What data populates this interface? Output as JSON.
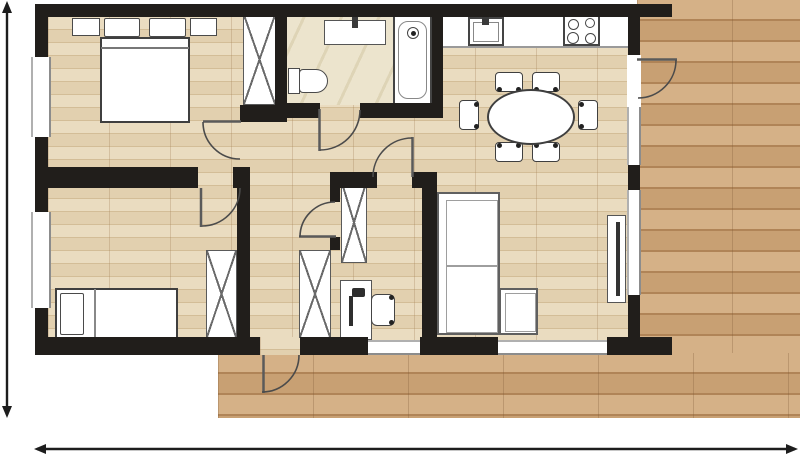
{
  "canvas": {
    "width": 800,
    "height": 456
  },
  "colors": {
    "wall": "#211e1b",
    "interior_floor": "#e8d8b9",
    "deck_floor": "#d1a97b",
    "tile_floor": "#ece4cd",
    "furniture_outline": "#4a4a4a",
    "door_arc": "#4b4b4b",
    "dimension": "#1d1d1d",
    "background": "#ffffff"
  },
  "plan": {
    "elements": [
      {
        "n": "deck-right",
        "c": "f-deck",
        "x": 637,
        "y": 0,
        "w": 163,
        "h": 418
      },
      {
        "n": "deck-balcony",
        "c": "f-deck",
        "x": 218,
        "y": 353,
        "w": 582,
        "h": 65
      },
      {
        "n": "interior-floor",
        "c": "f-wood",
        "x": 48,
        "y": 17,
        "w": 580,
        "h": 323
      },
      {
        "n": "balcony-doorway-floor",
        "c": "f-wood",
        "x": 260,
        "y": 337,
        "w": 40,
        "h": 18
      },
      {
        "n": "bathroom-floor",
        "c": "f-tile",
        "x": 287,
        "y": 17,
        "w": 145,
        "h": 88
      },
      {
        "n": "nightstand-left",
        "c": "box",
        "x": 72,
        "y": 18,
        "w": 28,
        "h": 18
      },
      {
        "n": "nightstand-right",
        "c": "box",
        "x": 190,
        "y": 18,
        "w": 27,
        "h": 18
      },
      {
        "n": "pillow-left",
        "c": "box",
        "x": 104,
        "y": 18,
        "w": 36,
        "h": 19,
        "r": "2px"
      },
      {
        "n": "pillow-right",
        "c": "box",
        "x": 149,
        "y": 18,
        "w": 37,
        "h": 19,
        "r": "2px"
      },
      {
        "n": "double-bed",
        "c": "box",
        "x": 100,
        "y": 37,
        "w": 90,
        "h": 86,
        "bw": 2,
        "bc": "#3f3f3f"
      },
      {
        "n": "double-bed-blanket-line",
        "c": "dark",
        "x": 101,
        "y": 47,
        "w": 88,
        "h": 2,
        "bg": "#777"
      },
      {
        "n": "wardrobe-bedroom1",
        "c": "xbox",
        "x": 243,
        "y": 14,
        "w": 33,
        "h": 91
      },
      {
        "n": "vanity-counter",
        "c": "box",
        "x": 324,
        "y": 20,
        "w": 62,
        "h": 25,
        "bc": "#555"
      },
      {
        "n": "vanity-faucet",
        "c": "dark",
        "x": 352,
        "y": 15,
        "w": 6,
        "h": 13
      },
      {
        "n": "toilet-tank",
        "c": "box",
        "x": 288,
        "y": 68,
        "w": 12,
        "h": 26
      },
      {
        "n": "toilet-bowl",
        "c": "box",
        "x": 299,
        "y": 69,
        "w": 29,
        "h": 24,
        "r": "4px 12px 12px 4px"
      },
      {
        "n": "bathtub",
        "c": "box",
        "x": 393,
        "y": 15,
        "w": 39,
        "h": 90,
        "bw": 2,
        "bc": "#444"
      },
      {
        "n": "bathtub-inner",
        "c": "box",
        "x": 398,
        "y": 21,
        "w": 29,
        "h": 78,
        "bw": 1.2,
        "bc": "#888",
        "r": "10px"
      },
      {
        "n": "shower-head",
        "c": "box",
        "x": 407,
        "y": 27,
        "w": 12,
        "h": 12,
        "bc": "#444",
        "r": "50%",
        "dots": [
          [
            413,
            33
          ]
        ]
      },
      {
        "n": "kitchen-counter",
        "c": "white",
        "x": 443,
        "y": 17,
        "w": 185,
        "h": 31,
        "bb": "2px solid #9a9a9a"
      },
      {
        "n": "kitchen-sink",
        "c": "box",
        "x": 468,
        "y": 17,
        "w": 36,
        "h": 29,
        "bw": 2,
        "bc": "#444"
      },
      {
        "n": "kitchen-sink-inner",
        "c": "box",
        "x": 473,
        "y": 22,
        "w": 26,
        "h": 20,
        "bw": 1.2,
        "bc": "#888"
      },
      {
        "n": "kitchen-faucet",
        "c": "dark",
        "x": 482,
        "y": 13,
        "w": 7,
        "h": 12
      },
      {
        "n": "stove",
        "c": "box",
        "x": 563,
        "y": 15,
        "w": 37,
        "h": 31,
        "bw": 2,
        "bc": "#444",
        "rings": [
          [
            572,
            23,
            9
          ],
          [
            589,
            22,
            8
          ],
          [
            572,
            37,
            10
          ],
          [
            589,
            37,
            9
          ]
        ]
      },
      {
        "n": "dining-chair-top-1",
        "c": "box",
        "x": 495,
        "y": 72,
        "w": 28,
        "h": 20,
        "bc": "#3f3f3f",
        "r": "4px",
        "dots": [
          [
            499,
            89
          ],
          [
            518,
            89
          ]
        ]
      },
      {
        "n": "dining-chair-top-2",
        "c": "box",
        "x": 532,
        "y": 72,
        "w": 28,
        "h": 20,
        "bc": "#3f3f3f",
        "r": "4px",
        "dots": [
          [
            536,
            89
          ],
          [
            555,
            89
          ]
        ]
      },
      {
        "n": "dining-chair-bottom-1",
        "c": "box",
        "x": 495,
        "y": 142,
        "w": 28,
        "h": 20,
        "bc": "#3f3f3f",
        "r": "4px",
        "dots": [
          [
            499,
            145
          ],
          [
            518,
            145
          ]
        ]
      },
      {
        "n": "dining-chair-bottom-2",
        "c": "box",
        "x": 532,
        "y": 142,
        "w": 28,
        "h": 20,
        "bc": "#3f3f3f",
        "r": "4px",
        "dots": [
          [
            536,
            145
          ],
          [
            555,
            145
          ]
        ]
      },
      {
        "n": "dining-chair-left",
        "c": "box",
        "x": 459,
        "y": 100,
        "w": 20,
        "h": 30,
        "bc": "#3f3f3f",
        "r": "4px",
        "dots": [
          [
            476,
            104
          ],
          [
            476,
            126
          ]
        ]
      },
      {
        "n": "dining-chair-right",
        "c": "box",
        "x": 578,
        "y": 100,
        "w": 20,
        "h": 30,
        "bc": "#3f3f3f",
        "r": "4px",
        "dots": [
          [
            581,
            104
          ],
          [
            581,
            126
          ]
        ]
      },
      {
        "n": "dining-table",
        "c": "box",
        "x": 487,
        "y": 89,
        "w": 88,
        "h": 56,
        "bw": 2,
        "bc": "#3f3f3f",
        "r": "50%"
      },
      {
        "n": "sofa",
        "c": "box",
        "x": 437,
        "y": 192,
        "w": 63,
        "h": 143,
        "bw": 2,
        "bc": "#606060"
      },
      {
        "n": "sofa-cushions",
        "c": "box",
        "x": 446,
        "y": 200,
        "w": 52,
        "h": 133,
        "bw": 1.2,
        "bc": "#9e9e9e"
      },
      {
        "n": "sofa-cushion-divider",
        "c": "dark",
        "x": 447,
        "y": 265,
        "w": 50,
        "h": 2,
        "bg": "#9e9e9e"
      },
      {
        "n": "sofa-chaise",
        "c": "box",
        "x": 499,
        "y": 288,
        "w": 39,
        "h": 47,
        "bw": 2,
        "bc": "#606060"
      },
      {
        "n": "sofa-chaise-cushion",
        "c": "box",
        "x": 505,
        "y": 293,
        "w": 31,
        "h": 39,
        "bw": 1.2,
        "bc": "#9e9e9e"
      },
      {
        "n": "tv-stand",
        "c": "box",
        "x": 607,
        "y": 215,
        "w": 19,
        "h": 88,
        "bc": "#555"
      },
      {
        "n": "tv-panel",
        "c": "dark",
        "x": 616,
        "y": 222,
        "w": 4,
        "h": 74,
        "bg": "#333"
      },
      {
        "n": "wardrobe-office",
        "c": "xbox",
        "x": 341,
        "y": 182,
        "w": 26,
        "h": 81
      },
      {
        "n": "desk",
        "c": "box",
        "x": 340,
        "y": 280,
        "w": 32,
        "h": 60,
        "bc": "#555"
      },
      {
        "n": "desk-lamp-stem",
        "c": "dark",
        "x": 349,
        "y": 296,
        "w": 4,
        "h": 30,
        "bg": "#2e2e2e"
      },
      {
        "n": "desk-lamp-head",
        "c": "dark",
        "x": 352,
        "y": 288,
        "w": 13,
        "h": 9,
        "bg": "#2e2e2e",
        "r": "2px"
      },
      {
        "n": "office-chair",
        "c": "box",
        "x": 371,
        "y": 294,
        "w": 24,
        "h": 32,
        "bc": "#444",
        "r": "6px",
        "dots": [
          [
            391,
            297
          ],
          [
            391,
            322
          ]
        ]
      },
      {
        "n": "wardrobe-bedroom2",
        "c": "xbox",
        "x": 206,
        "y": 250,
        "w": 31,
        "h": 88
      },
      {
        "n": "closet-hall",
        "c": "xbox",
        "x": 299,
        "y": 250,
        "w": 32,
        "h": 88
      },
      {
        "n": "single-bed",
        "c": "box",
        "x": 55,
        "y": 288,
        "w": 123,
        "h": 52,
        "bw": 2,
        "bc": "#3f3f3f"
      },
      {
        "n": "single-bed-pillow",
        "c": "box",
        "x": 60,
        "y": 293,
        "w": 24,
        "h": 42,
        "r": "2px"
      },
      {
        "n": "single-bed-fold-line",
        "c": "dark",
        "x": 94,
        "y": 289,
        "w": 2,
        "h": 50,
        "bg": "#888"
      },
      {
        "n": "wall-top",
        "c": "wall",
        "x": 35,
        "y": 4,
        "w": 637,
        "h": 13
      },
      {
        "n": "wall-left",
        "c": "wall",
        "x": 35,
        "y": 4,
        "w": 13,
        "h": 351
      },
      {
        "n": "wall-bottom-1",
        "c": "wall",
        "x": 35,
        "y": 337,
        "w": 225,
        "h": 18
      },
      {
        "n": "wall-bottom-2",
        "c": "wall",
        "x": 300,
        "y": 337,
        "w": 68,
        "h": 18
      },
      {
        "n": "wall-bottom-3",
        "c": "wall",
        "x": 420,
        "y": 337,
        "w": 78,
        "h": 18
      },
      {
        "n": "wall-bottom-4",
        "c": "wall",
        "x": 607,
        "y": 337,
        "w": 65,
        "h": 18
      },
      {
        "n": "wall-right",
        "c": "wall",
        "x": 628,
        "y": 4,
        "w": 12,
        "h": 351
      },
      {
        "n": "wall-bathroom-left",
        "c": "wall",
        "x": 275,
        "y": 17,
        "w": 12,
        "h": 101
      },
      {
        "n": "wall-bathroom-kitchen",
        "c": "wall",
        "x": 432,
        "y": 17,
        "w": 11,
        "h": 101
      },
      {
        "n": "wall-bathroom-south-1",
        "c": "wall",
        "x": 287,
        "y": 103,
        "w": 33,
        "h": 15
      },
      {
        "n": "wall-bathroom-south-2",
        "c": "wall",
        "x": 360,
        "y": 103,
        "w": 72,
        "h": 15
      },
      {
        "n": "wall-bedroom1-nook",
        "c": "wall",
        "x": 240,
        "y": 105,
        "w": 47,
        "h": 17
      },
      {
        "n": "wall-bedroom-divider",
        "c": "wall",
        "x": 35,
        "y": 167,
        "w": 163,
        "h": 21
      },
      {
        "n": "wall-bedroom-divider-right",
        "c": "wall",
        "x": 233,
        "y": 167,
        "w": 17,
        "h": 21
      },
      {
        "n": "wall-corridor-left",
        "c": "wall",
        "x": 237,
        "y": 188,
        "w": 13,
        "h": 149
      },
      {
        "n": "wall-office-top-1",
        "c": "wall",
        "x": 330,
        "y": 172,
        "w": 47,
        "h": 16
      },
      {
        "n": "wall-office-top-2",
        "c": "wall",
        "x": 412,
        "y": 172,
        "w": 25,
        "h": 16
      },
      {
        "n": "wall-office-left-1",
        "c": "wall",
        "x": 330,
        "y": 188,
        "w": 10,
        "h": 14
      },
      {
        "n": "wall-office-left-2",
        "c": "wall",
        "x": 330,
        "y": 237,
        "w": 10,
        "h": 13
      },
      {
        "n": "wall-office-right",
        "c": "wall",
        "x": 422,
        "y": 188,
        "w": 15,
        "h": 149
      },
      {
        "n": "window-bedroom1",
        "c": "win-v",
        "x": 31,
        "y": 57,
        "w": 20,
        "h": 80
      },
      {
        "n": "window-bedroom2",
        "c": "win-v",
        "x": 31,
        "y": 212,
        "w": 20,
        "h": 96
      },
      {
        "n": "entry-opening",
        "c": "white",
        "x": 627,
        "y": 55,
        "w": 14,
        "h": 52
      },
      {
        "n": "window-right-upper",
        "c": "win-v",
        "x": 627,
        "y": 107,
        "w": 14,
        "h": 58
      },
      {
        "n": "window-right-lower",
        "c": "win-v",
        "x": 627,
        "y": 190,
        "w": 14,
        "h": 105
      },
      {
        "n": "window-office",
        "c": "win-h",
        "x": 368,
        "y": 340,
        "w": 52,
        "h": 15
      },
      {
        "n": "window-living",
        "c": "win-h",
        "x": 498,
        "y": 340,
        "w": 109,
        "h": 15
      }
    ],
    "svg": {
      "paths": [
        {
          "n": "door-bedroom1-leaf",
          "d": "M203,121.5 L241,121.5",
          "w": 2.5,
          "s": "#5a5a5a"
        },
        {
          "n": "door-bedroom1-arc",
          "d": "M203,122 A37 37 0 0 0 240,159",
          "w": 1.6,
          "s": "#4b4b4b"
        },
        {
          "n": "door-bedroom2-leaf",
          "d": "M201,188 L201,227",
          "w": 2.5,
          "s": "#5a5a5a"
        },
        {
          "n": "door-bedroom2-arc",
          "d": "M240,188 A38 38 0 0 1 202,226",
          "w": 1.6,
          "s": "#4b4b4b"
        },
        {
          "n": "door-bathroom-leaf",
          "d": "M319.5,109 L319.5,151",
          "w": 2.5,
          "s": "#5a5a5a"
        },
        {
          "n": "door-bathroom-arc",
          "d": "M320,150 A40 40 0 0 0 360,110",
          "w": 1.6,
          "s": "#4b4b4b"
        },
        {
          "n": "door-office-leaf",
          "d": "M299,236.5 L336,236.5",
          "w": 2.5,
          "s": "#5a5a5a"
        },
        {
          "n": "door-office-arc",
          "d": "M300,237 A35 35 0 0 1 335,202",
          "w": 1.6,
          "s": "#4b4b4b"
        },
        {
          "n": "door-hall-leaf",
          "d": "M412.5,177 L412.5,137",
          "w": 2.5,
          "s": "#5a5a5a"
        },
        {
          "n": "door-hall-arc",
          "d": "M373,177 A39 39 0 0 1 412,138",
          "w": 1.6,
          "s": "#4b4b4b"
        },
        {
          "n": "door-balcony-leaf",
          "d": "M263.5,355 L263.5,393",
          "w": 2.5,
          "s": "#5a5a5a"
        },
        {
          "n": "door-balcony-arc",
          "d": "M262,392 A37 37 0 0 0 299,355",
          "w": 1.6,
          "s": "#4b4b4b"
        },
        {
          "n": "door-entry-leaf",
          "d": "M637,59.5 L677,59.5",
          "w": 2.5,
          "s": "#5a5a5a"
        },
        {
          "n": "door-entry-arc",
          "d": "M676,60 A38 38 0 0 1 638,98",
          "w": 1.6,
          "s": "#4b4b4b"
        },
        {
          "n": "dimension-line-vertical",
          "d": "M7,4 L7,415",
          "w": 2.4,
          "s": "#1d1d1d"
        },
        {
          "n": "dimension-line-horizontal",
          "d": "M37,449 L795,449",
          "w": 2.4,
          "s": "#1d1d1d"
        }
      ],
      "polys": [
        {
          "n": "dim-arrow-top",
          "p": "7,1 2,13 12,13"
        },
        {
          "n": "dim-arrow-bottom",
          "p": "7,418 2,406 12,406"
        },
        {
          "n": "dim-arrow-left",
          "p": "34,449 46,444 46,454"
        },
        {
          "n": "dim-arrow-right",
          "p": "798,449 786,444 786,454"
        }
      ]
    }
  }
}
